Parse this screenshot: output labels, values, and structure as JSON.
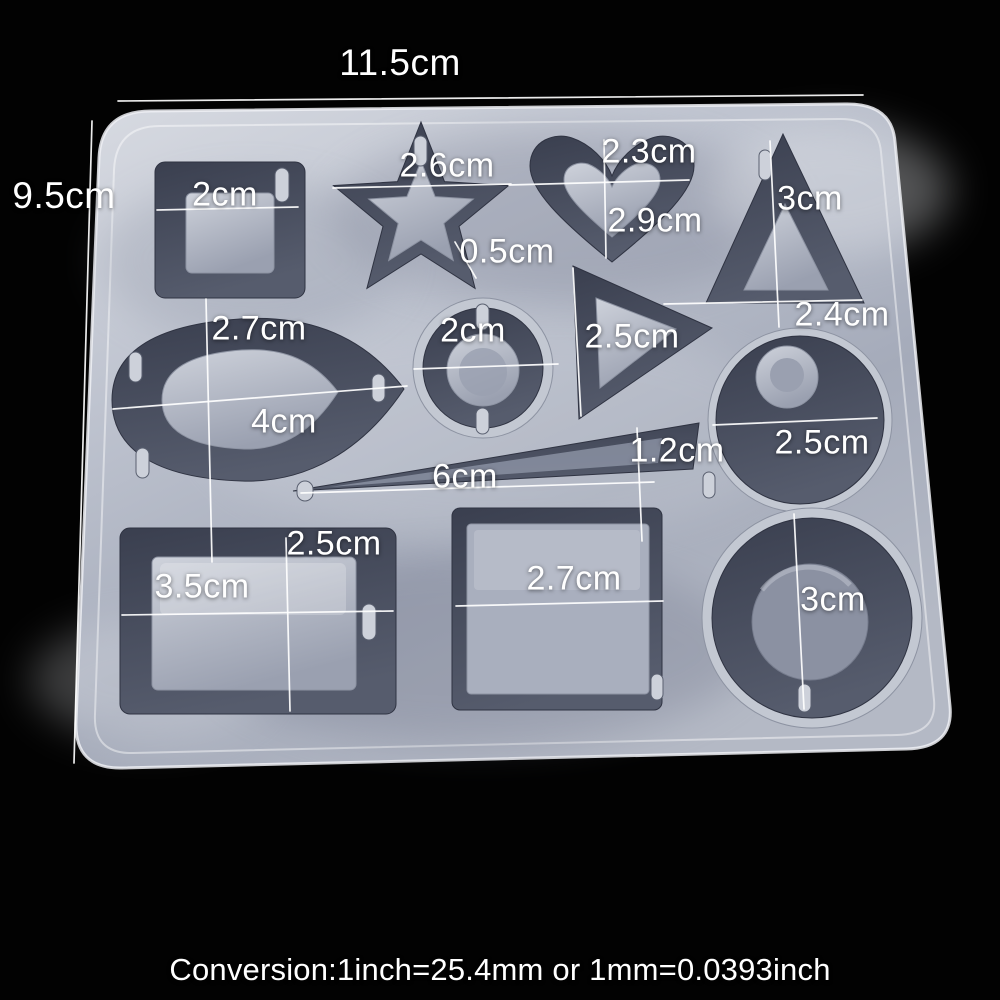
{
  "photo": {
    "subject": "silicone resin casting mold with 12 jewelry cavities",
    "colors": {
      "background": "#000000",
      "mold_body": "#b7bdca",
      "mold_highlight": "#dde0e7",
      "cavity_wall": "#454b5c",
      "island": "#b2b8c5",
      "annotation_text": "#ffffff",
      "measurement_line": "#ffffff"
    }
  },
  "dims": {
    "overall_w": "11.5cm",
    "overall_h": "9.5cm",
    "square": {
      "w": "2cm"
    },
    "star": {
      "w": "2.6cm",
      "ring": "0.5cm"
    },
    "heart": {
      "w": "2.3cm",
      "h": "2.9cm"
    },
    "triangle": {
      "h": "3cm",
      "w": "2.4cm"
    },
    "teardrop": {
      "w": "2.7cm",
      "l": "4cm"
    },
    "circle_small": {
      "d": "2cm"
    },
    "triangle_small": {
      "l": "2.5cm"
    },
    "circle_right": {
      "d": "2.5cm"
    },
    "spike": {
      "l": "6cm",
      "w": "1.2cm"
    },
    "rectangle": {
      "h": "2.5cm",
      "w": "3.5cm"
    },
    "square_large": {
      "w": "2.7cm"
    },
    "circle_large": {
      "d": "3cm"
    }
  },
  "shapes": [
    "square pendant",
    "star pendant",
    "heart pendant",
    "triangle pendant",
    "teardrop pendant",
    "small circle donut",
    "small triangle",
    "circle with hole post",
    "long spike",
    "rectangle pendant",
    "large square pendant",
    "large circle donut"
  ],
  "footer": {
    "conversion": "Conversion:1inch=25.4mm or 1mm=0.0393inch"
  }
}
